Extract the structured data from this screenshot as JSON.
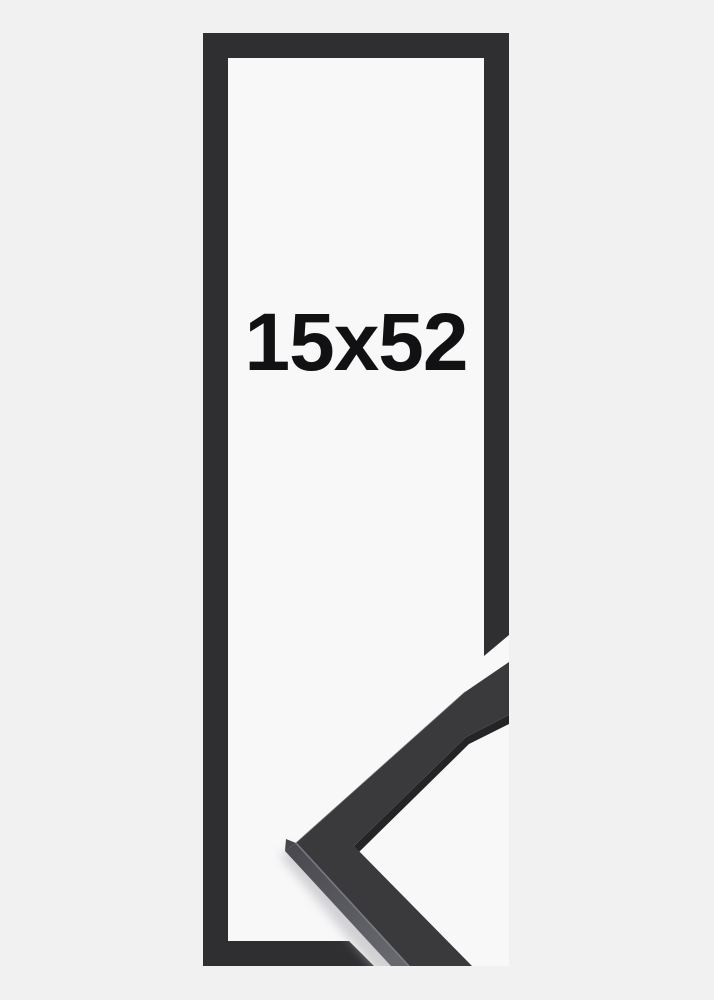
{
  "page": {
    "background": "#f1f1f2"
  },
  "product": {
    "size_label": "15x52"
  },
  "photo": {
    "background": "#f8f8f9"
  },
  "colors": {
    "frame_outline": "#2f2f32",
    "corner_top_face": "#3a3a3d",
    "corner_inner_edge": "#242427",
    "corner_side_top": "#47474d",
    "corner_side_bottom": "#67676e",
    "corner_apex_facet": "#46464c",
    "edge_highlight": "#82828a",
    "shadow": "#aaaaaf"
  }
}
